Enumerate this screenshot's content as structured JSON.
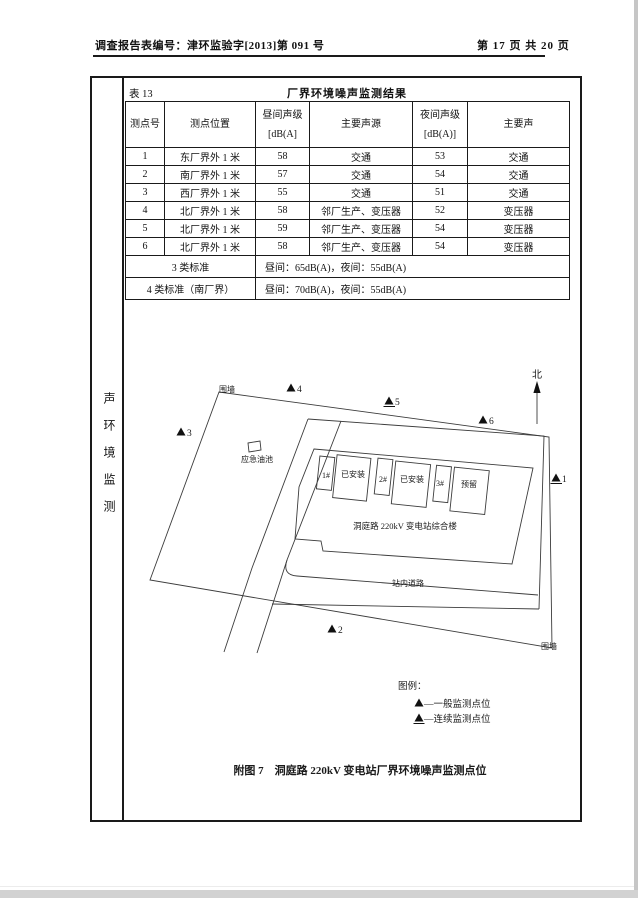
{
  "page": {
    "header_left": "调查报告表编号：津环监验字[2013]第 091 号",
    "header_right": "第 17 页 共 20 页"
  },
  "sidebar": {
    "label": "声环境监测"
  },
  "table": {
    "tag": "表 13",
    "title": "厂界环境噪声监测结果",
    "headers": [
      "测点号",
      "测点位置",
      {
        "l1": "昼间声级",
        "l2": "[dB(A]"
      },
      "主要声源",
      {
        "l1": "夜间声级",
        "l2": "[dB(A)]"
      },
      "主要声"
    ],
    "rows": [
      [
        "1",
        "东厂界外 1 米",
        "58",
        "交通",
        "53",
        "交通"
      ],
      [
        "2",
        "南厂界外 1 米",
        "57",
        "交通",
        "54",
        "交通"
      ],
      [
        "3",
        "西厂界外 1 米",
        "55",
        "交通",
        "51",
        "交通"
      ],
      [
        "4",
        "北厂界外 1 米",
        "58",
        "邻厂生产、变压器",
        "52",
        "变压器"
      ],
      [
        "5",
        "北厂界外 1 米",
        "59",
        "邻厂生产、变压器",
        "54",
        "变压器"
      ],
      [
        "6",
        "北厂界外 1 米",
        "58",
        "邻厂生产、变压器",
        "54",
        "变压器"
      ]
    ],
    "standards": [
      {
        "label": "3 类标准",
        "value": "昼间：65dB(A)，夜间：55dB(A)"
      },
      {
        "label": "4 类标准（南厂界）",
        "value": "昼间：70dB(A)，夜间：55dB(A)"
      }
    ]
  },
  "diagram": {
    "north": "北",
    "wall_top": "围墙",
    "wall_bottom": "围墙",
    "oil_pool": "应急油池",
    "buildings": [
      {
        "num": "1#",
        "status": "已安装"
      },
      {
        "num": "2#",
        "status": "已安装"
      },
      {
        "num": "3#",
        "status": "预留"
      }
    ],
    "main_building": "洞庭路 220kV 变电站综合楼",
    "road": "站内道路",
    "points": [
      {
        "num": "1",
        "type": "continuous"
      },
      {
        "num": "2",
        "type": "general"
      },
      {
        "num": "3",
        "type": "general"
      },
      {
        "num": "4",
        "type": "general"
      },
      {
        "num": "5",
        "type": "continuous"
      },
      {
        "num": "6",
        "type": "general"
      }
    ],
    "legend_title": "图例：",
    "legend_general": "—一般监测点位",
    "legend_continuous": "—连续监测点位",
    "caption": "附图 7　洞庭路 220kV 变电站厂界环境噪声监测点位"
  }
}
